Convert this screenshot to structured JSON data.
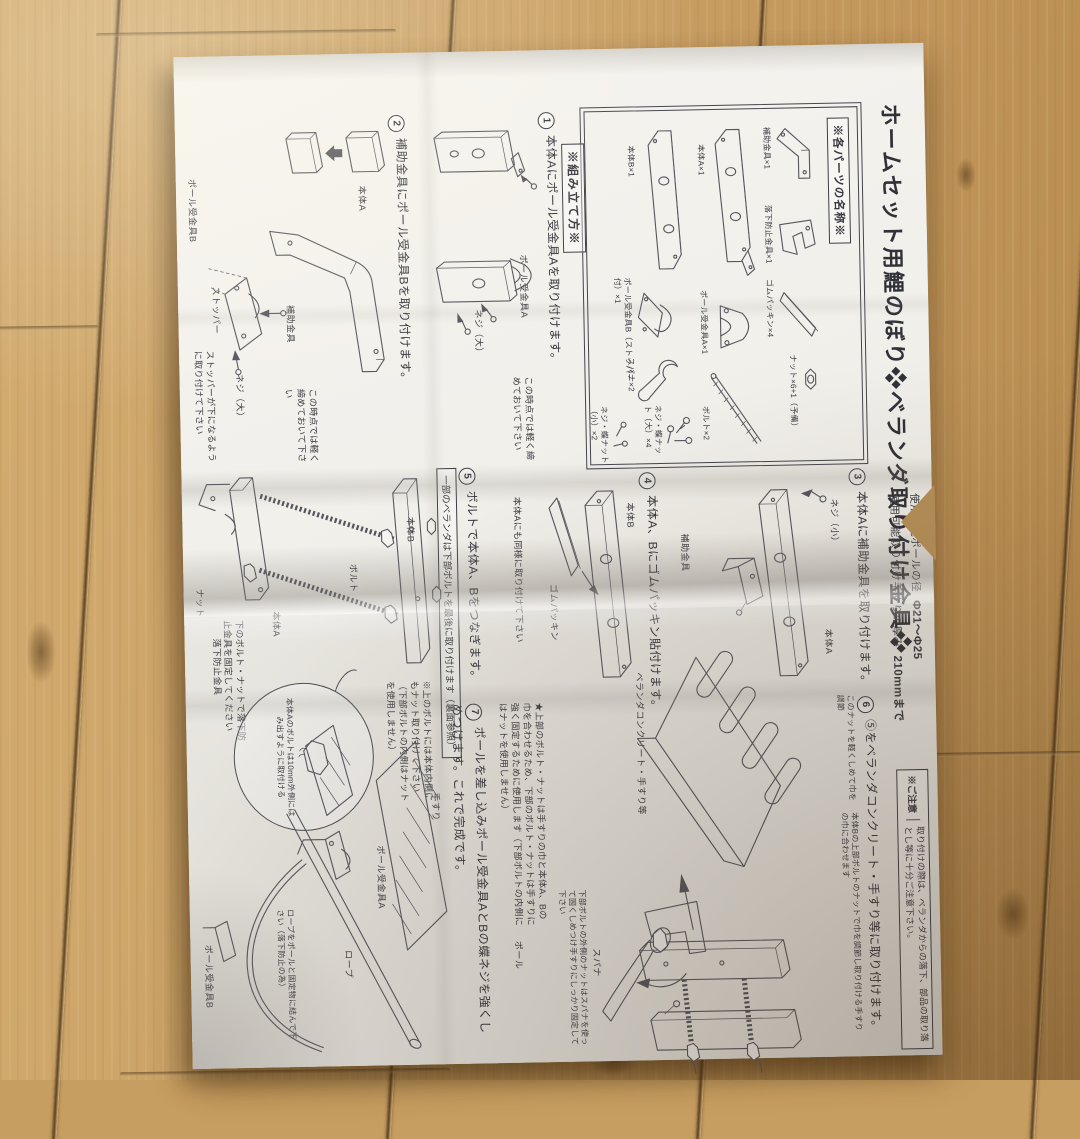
{
  "title": "ホームセット用鯉のぼり❖ベランダ取り付け金具❖",
  "specs": {
    "pole_label": "使用可能ポールの径",
    "pole_value": "Φ21～Φ25",
    "wall_label": "使用可能取り付け手すりの厚み",
    "wall_value": "210mmまで"
  },
  "caution": {
    "tag": "※ご注意",
    "text": "取り付けの際は、ベランダからの落下、部品の取り落とし等に十分ご注意下さい。"
  },
  "parts_header": "※各パーツの名称※",
  "parts": {
    "hojo": "補助金具×1",
    "rakka": "落下防止金具×1",
    "gomu": "ゴムパッキン×4",
    "nut": "ナット×6+1（予備）",
    "honA": "本体A×1",
    "ukeA": "ポール受金具A×1",
    "bolt": "ボルト×2",
    "honB": "本体B×1",
    "ukeB": "ポール受金具B（ストッパー付）×1",
    "spana": "スパナ×2",
    "neji_dai": "ネジ・蝶ナット（大）×4",
    "neji_sho": "ネジ・蝶ナット（小）×2"
  },
  "assembly_header": "※組み立て方※",
  "step1": {
    "num": "1",
    "text": "本体Aにポール受金具Aを取り付けます。",
    "note": "この時点では軽く締めておいて下さい",
    "label_ukeA": "ポール受金具A",
    "label_neji": "ネジ（大）"
  },
  "step2": {
    "num": "2",
    "text": "補助金具にポール受金具Bを取り付けます。",
    "note": "この時点では軽く締めておいて下さい",
    "label_honA": "本体A",
    "label_hojo": "補助金具",
    "label_ukeB": "ポール受金具B",
    "label_stopper": "ストッパー",
    "label_neji": "ネジ（大）",
    "note2": "ストッパーが下になるように取り付けて下さい"
  },
  "step3": {
    "num": "3",
    "text": "本体Aに補助金具を取り付けます。",
    "label_neji": "ネジ（小）",
    "label_honA": "本体A",
    "label_hojo": "補助金具"
  },
  "step4": {
    "num": "4",
    "text": "本体A、Bにゴムパッキン貼付けます。",
    "label_honB": "本体B",
    "label_gomu": "ゴムパッキン",
    "note": "本体Aにも同様に取り付けて下さい"
  },
  "step5": {
    "num": "5",
    "text": "ボルトで本体A、Bをつなぎます。",
    "boxed_note": "一部のベランダは下部ボルトを最後に取り付けます（裏面参照）",
    "label_honB": "本体B",
    "label_bolt": "ボルト",
    "label_honA": "本体A",
    "label_nut": "ナット",
    "label_rakka": "落下防止金具",
    "note_inner": "※上のボルトには本体内側にもナット取り付けて下さい（下部ボルトの内側はナットを使用しません）",
    "balloon": "本体Aのボルトは10mm外側にはみ出すように取付ける",
    "note_bottom": "下のボルト・ナットで落下防止金具を固定してください"
  },
  "step6": {
    "num": "6",
    "text": "⑤をベランダコンクリート・手すり等に取り付けます。",
    "label_nut_adjust": "このナットを軽くしめて巾を調節",
    "label_width": "本体Bの上部ボルトのナットで巾を調節し取り付ける手すりの巾に合わせます",
    "label_veranda": "ベランダコンクリート・手すり等"
  },
  "step7": {
    "num": "7",
    "text": "ポールを差し込みポール受金具AとBの蝶ネジを強くしめつけます。これで完成です。",
    "star_note": "★上部のボルト・ナットは手すりの巾と本体A、Bの巾を合わせるため、下部のボルト・ナットは手すりに強く固定するために使用します（下部ボルトの内側にはナットを使用しません）",
    "spanner_note": "下部ボルトの外側のナットはスパナを使って固くしめつけ手すりにしっかり固定して下さい",
    "label_spana": "スパナ",
    "label_tesuri": "手すり",
    "label_pole": "ポール",
    "label_ukeA": "ポール受金具A",
    "label_ukeB": "ポール受金具B",
    "label_rope": "ロープ",
    "rope_note": "ロープをポールと固定物に結んで下さい（落下防止の為）"
  }
}
